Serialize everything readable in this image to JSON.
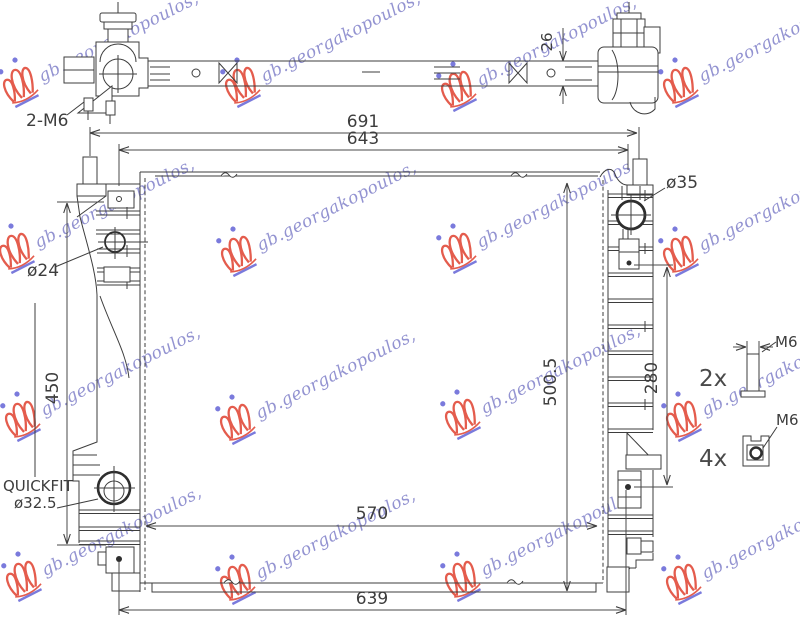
{
  "labels": {
    "top": {
      "bolt_callout": "2-M6",
      "thickness": "26"
    },
    "front": {
      "overall_width": "691",
      "mount_width": "643",
      "inlet": "ø35",
      "port": "ø24",
      "left_height": "450",
      "core_height": "500.5",
      "bracket_span": "280",
      "core_width": "570",
      "mount_width_bottom": "639",
      "quickfit_name": "QUICKFIT",
      "quickfit_size": "ø32.5"
    },
    "hardware": {
      "bolt_qty": "2x",
      "bolt_size": "M6",
      "clip_qty": "4x",
      "clip_size": "M6"
    }
  },
  "colors": {
    "line": "#3d3d3d",
    "watermark_text": "#8181c9",
    "watermark_logo_red": "#e0402e",
    "watermark_logo_blue": "#6363d6"
  },
  "watermark": {
    "text": "gb.georgakopoulos,",
    "instances": [
      {
        "x": 6,
        "y": 58
      },
      {
        "x": 228,
        "y": 58
      },
      {
        "x": 444,
        "y": 62
      },
      {
        "x": 666,
        "y": 58
      },
      {
        "x": 2,
        "y": 224
      },
      {
        "x": 224,
        "y": 227
      },
      {
        "x": 444,
        "y": 224
      },
      {
        "x": 666,
        "y": 227
      },
      {
        "x": 8,
        "y": 392
      },
      {
        "x": 223,
        "y": 395
      },
      {
        "x": 448,
        "y": 390
      },
      {
        "x": 669,
        "y": 392
      },
      {
        "x": 9,
        "y": 552
      },
      {
        "x": 223,
        "y": 555
      },
      {
        "x": 448,
        "y": 552
      },
      {
        "x": 669,
        "y": 555
      }
    ]
  }
}
